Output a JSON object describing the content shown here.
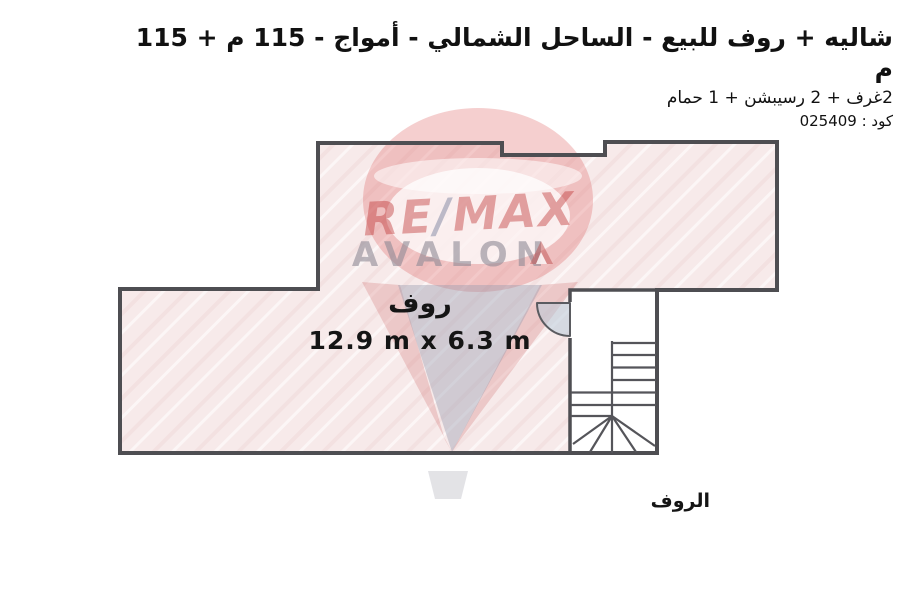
{
  "header": {
    "title": "شاليه + روف للبيع - الساحل الشمالي - أمواج - 115 م + 115 م",
    "subtitle": "2غرف + 2 رسيبشن + 1 حمام",
    "code": "كود : 025409"
  },
  "floor_plan": {
    "room_label": "روف",
    "room_dimensions": "12.9 m x 6.3 m",
    "floor_label": "الروف",
    "colors": {
      "floor_fill": "#f7eaea",
      "floor_streak": "#f0dada",
      "wall": "#4e4e52",
      "stair_line": "#55555a",
      "door_swing": "#bacbd8",
      "text": "#151515"
    }
  },
  "watermark": {
    "brand_re": "RE",
    "brand_slash": "/",
    "brand_max": "MAX",
    "name": "AVALON",
    "balloon_red": "#dd5f5f",
    "balloon_gray": "#9aa0b5"
  }
}
